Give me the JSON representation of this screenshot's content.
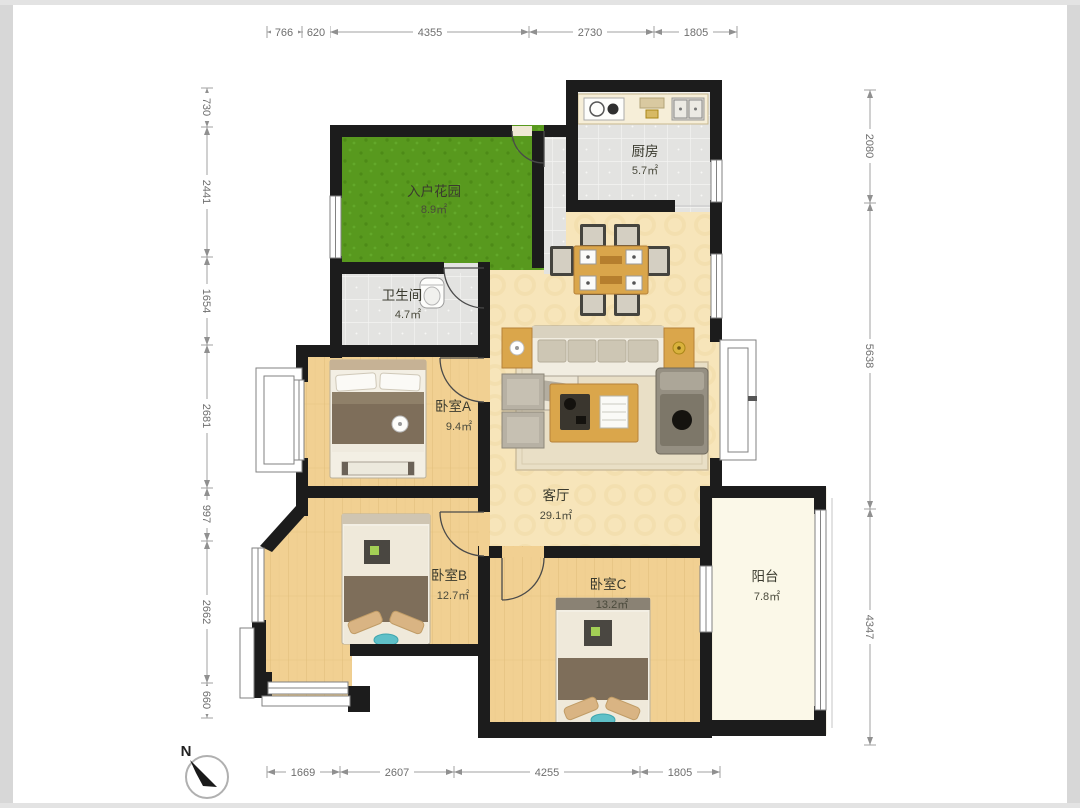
{
  "floor_plan": {
    "rooms": [
      {
        "id": "entry-garden",
        "name": "入户花园",
        "area": "8.9㎡"
      },
      {
        "id": "kitchen",
        "name": "厨房",
        "area": "5.7㎡"
      },
      {
        "id": "bathroom",
        "name": "卫生间",
        "area": "4.7㎡"
      },
      {
        "id": "bedroom-a",
        "name": "卧室A",
        "area": "9.4㎡"
      },
      {
        "id": "living-room",
        "name": "客厅",
        "area": "29.1㎡"
      },
      {
        "id": "bedroom-b",
        "name": "卧室B",
        "area": "12.7㎡"
      },
      {
        "id": "bedroom-c",
        "name": "卧室C",
        "area": "13.2㎡"
      },
      {
        "id": "balcony",
        "name": "阳台",
        "area": "7.8㎡"
      }
    ],
    "dimensions_mm": {
      "top": [
        "766",
        "620",
        "4355",
        "2730",
        "1805"
      ],
      "left": [
        "730",
        "2441",
        "1654",
        "2681",
        "997",
        "2662",
        "660"
      ],
      "right": [
        "2080",
        "5638",
        "4347"
      ],
      "bottom": [
        "1669",
        "2607",
        "4255",
        "1805"
      ]
    },
    "compass": {
      "label": "N"
    },
    "colors": {
      "wall": "#1c1c1c",
      "garden_green": "#58991e",
      "tile_gray": "#e3e3e1",
      "bedroom_wood": "#f1d092",
      "living_parquet": "#f7e5ba",
      "balcony_cream": "#fbf8e8",
      "furniture_wood": "#daa64b"
    }
  }
}
